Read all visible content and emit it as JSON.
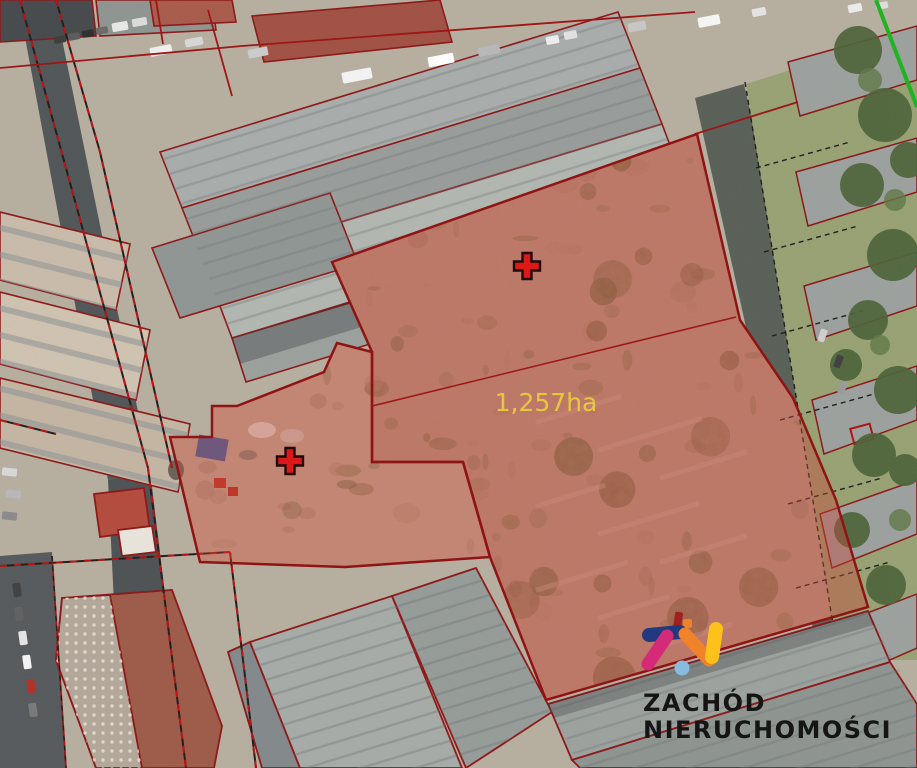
{
  "map": {
    "kind": "aerial-cadastral-parcel-map",
    "area_label": {
      "text": "1,257ha",
      "color": "#e9c83a",
      "x": 546,
      "y": 411,
      "font_size": 25
    },
    "highlighted_parcel": {
      "fill": "#c8453a",
      "fill_opacity": 0.42,
      "stroke": "#8e0f0f",
      "stroke_width": 2.5
    },
    "markers": {
      "symbol": "plus",
      "color": "#dd1414",
      "outline": "#1a0505",
      "points": [
        {
          "x": 527,
          "y": 266
        },
        {
          "x": 290,
          "y": 461
        }
      ]
    },
    "cadastral_line_color": "#9c1212",
    "cadastral_dash_color": "#1c1c1c",
    "boundary_line_green": {
      "color": "#1cb31c",
      "x1": 876,
      "y1": 0,
      "x2": 917,
      "y2": 107
    }
  },
  "watermark": {
    "line1": "ZACHÓD",
    "line2": "NIERUCHOMOŚCI",
    "text_color": "#151515",
    "icon_colors": {
      "navy": "#21397f",
      "magenta": "#d42a78",
      "orange": "#f0822a",
      "yellow": "#fcc21b",
      "sky": "#87bbdf",
      "dark_red": "#a02020"
    }
  }
}
